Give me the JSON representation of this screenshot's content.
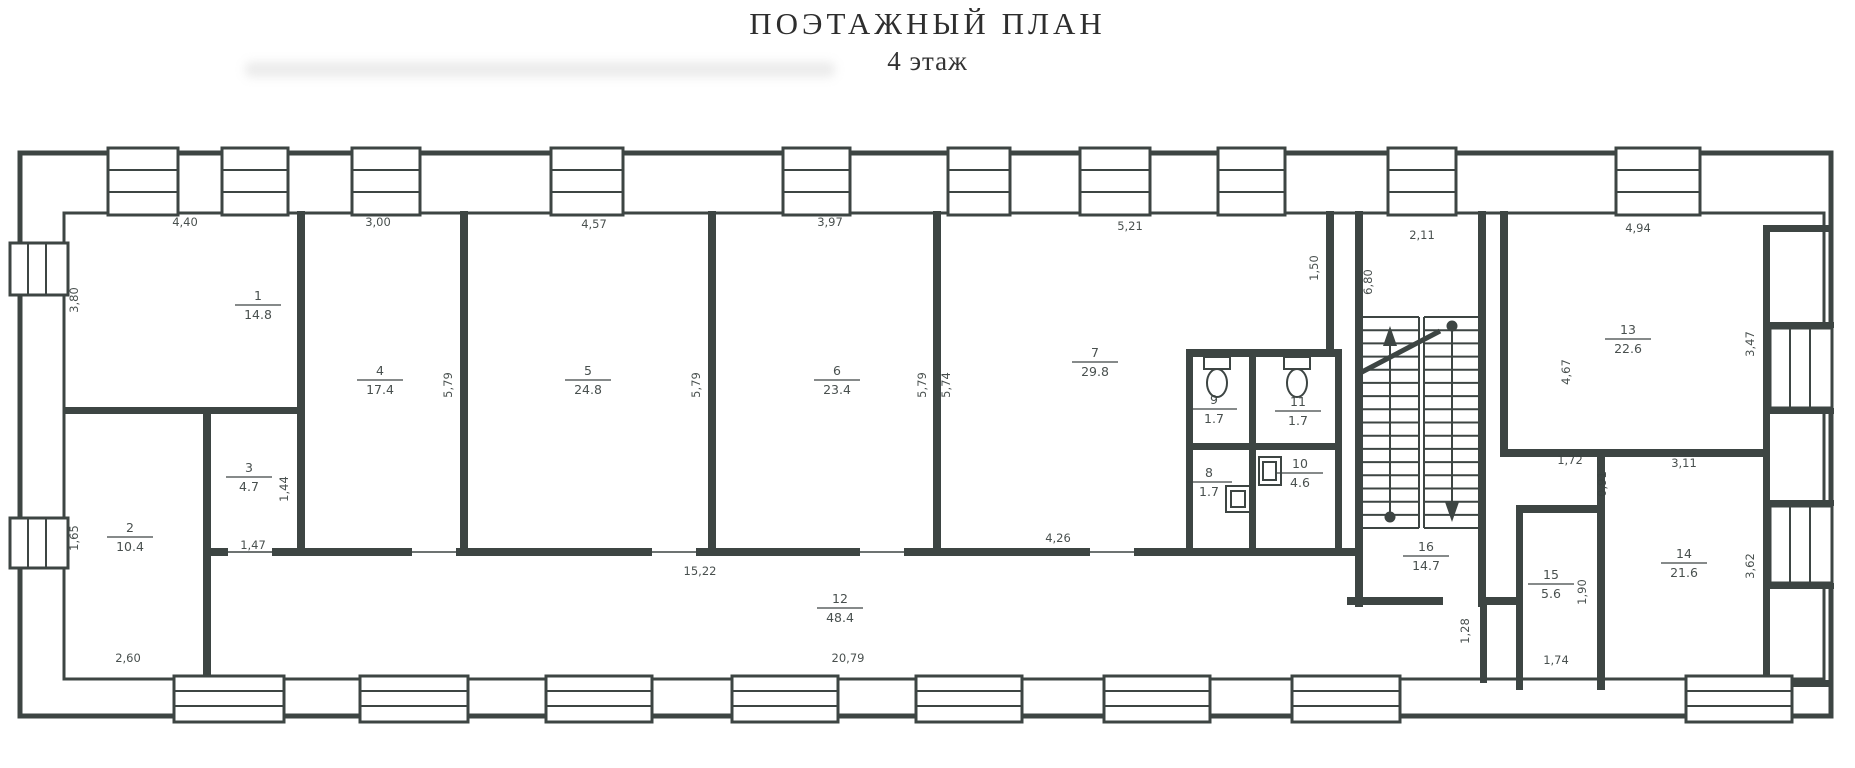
{
  "title": "ПОЭТАЖНЫЙ ПЛАН",
  "subtitle": "4 этаж",
  "colors": {
    "ink": "#3d4543",
    "paper": "#ffffff"
  },
  "rooms": [
    {
      "number": "1",
      "area": "14.8",
      "x": 258,
      "y": 300
    },
    {
      "number": "2",
      "area": "10.4",
      "x": 130,
      "y": 532
    },
    {
      "number": "3",
      "area": "4.7",
      "x": 249,
      "y": 472
    },
    {
      "number": "4",
      "area": "17.4",
      "x": 380,
      "y": 375
    },
    {
      "number": "5",
      "area": "24.8",
      "x": 588,
      "y": 375
    },
    {
      "number": "6",
      "area": "23.4",
      "x": 837,
      "y": 375
    },
    {
      "number": "7",
      "area": "29.8",
      "x": 1095,
      "y": 357
    },
    {
      "number": "8",
      "area": "1.7",
      "x": 1209,
      "y": 477
    },
    {
      "number": "9",
      "area": "1.7",
      "x": 1214,
      "y": 404
    },
    {
      "number": "10",
      "area": "4.6",
      "x": 1300,
      "y": 468
    },
    {
      "number": "11",
      "area": "1.7",
      "x": 1298,
      "y": 406
    },
    {
      "number": "12",
      "area": "48.4",
      "x": 840,
      "y": 603
    },
    {
      "number": "13",
      "area": "22.6",
      "x": 1628,
      "y": 334
    },
    {
      "number": "14",
      "area": "21.6",
      "x": 1684,
      "y": 558
    },
    {
      "number": "15",
      "area": "5.6",
      "x": 1551,
      "y": 579
    },
    {
      "number": "16",
      "area": "14.7",
      "x": 1426,
      "y": 551
    }
  ],
  "dimensions": [
    {
      "text": "4,40",
      "x": 185,
      "y": 226,
      "angle": 0
    },
    {
      "text": "3,00",
      "x": 378,
      "y": 226,
      "angle": 0
    },
    {
      "text": "4,57",
      "x": 594,
      "y": 228,
      "angle": 0
    },
    {
      "text": "3,97",
      "x": 830,
      "y": 226,
      "angle": 0
    },
    {
      "text": "5,21",
      "x": 1130,
      "y": 230,
      "angle": 0
    },
    {
      "text": "2,11",
      "x": 1422,
      "y": 239,
      "angle": 0
    },
    {
      "text": "4,94",
      "x": 1638,
      "y": 232,
      "angle": 0
    },
    {
      "text": "3,80",
      "x": 78,
      "y": 300,
      "angle": -90
    },
    {
      "text": "5,79",
      "x": 452,
      "y": 385,
      "angle": -90
    },
    {
      "text": "5,79",
      "x": 700,
      "y": 385,
      "angle": -90
    },
    {
      "text": "5,79",
      "x": 926,
      "y": 385,
      "angle": -90
    },
    {
      "text": "5,74",
      "x": 950,
      "y": 385,
      "angle": -90
    },
    {
      "text": "1,50",
      "x": 1318,
      "y": 268,
      "angle": -90
    },
    {
      "text": "6,80",
      "x": 1372,
      "y": 282,
      "angle": -90
    },
    {
      "text": "4,67",
      "x": 1570,
      "y": 372,
      "angle": -90
    },
    {
      "text": "3,47",
      "x": 1754,
      "y": 344,
      "angle": -90
    },
    {
      "text": "1,44",
      "x": 288,
      "y": 489,
      "angle": -90
    },
    {
      "text": "1,47",
      "x": 253,
      "y": 549,
      "angle": 0
    },
    {
      "text": "1,65",
      "x": 78,
      "y": 538,
      "angle": -90
    },
    {
      "text": "2,60",
      "x": 128,
      "y": 662,
      "angle": 0
    },
    {
      "text": "15,22",
      "x": 700,
      "y": 575,
      "angle": 0
    },
    {
      "text": "4,26",
      "x": 1058,
      "y": 542,
      "angle": 0
    },
    {
      "text": "20,79",
      "x": 848,
      "y": 662,
      "angle": 0
    },
    {
      "text": "3,11",
      "x": 1684,
      "y": 467,
      "angle": 0
    },
    {
      "text": "3,62",
      "x": 1754,
      "y": 566,
      "angle": -90
    },
    {
      "text": "1,72",
      "x": 1570,
      "y": 464,
      "angle": 0
    },
    {
      "text": "0,91",
      "x": 1606,
      "y": 484,
      "angle": -90
    },
    {
      "text": "1,90",
      "x": 1586,
      "y": 592,
      "angle": -90
    },
    {
      "text": "1,74",
      "x": 1556,
      "y": 664,
      "angle": 0
    },
    {
      "text": "1,28",
      "x": 1469,
      "y": 631,
      "angle": -90
    }
  ]
}
